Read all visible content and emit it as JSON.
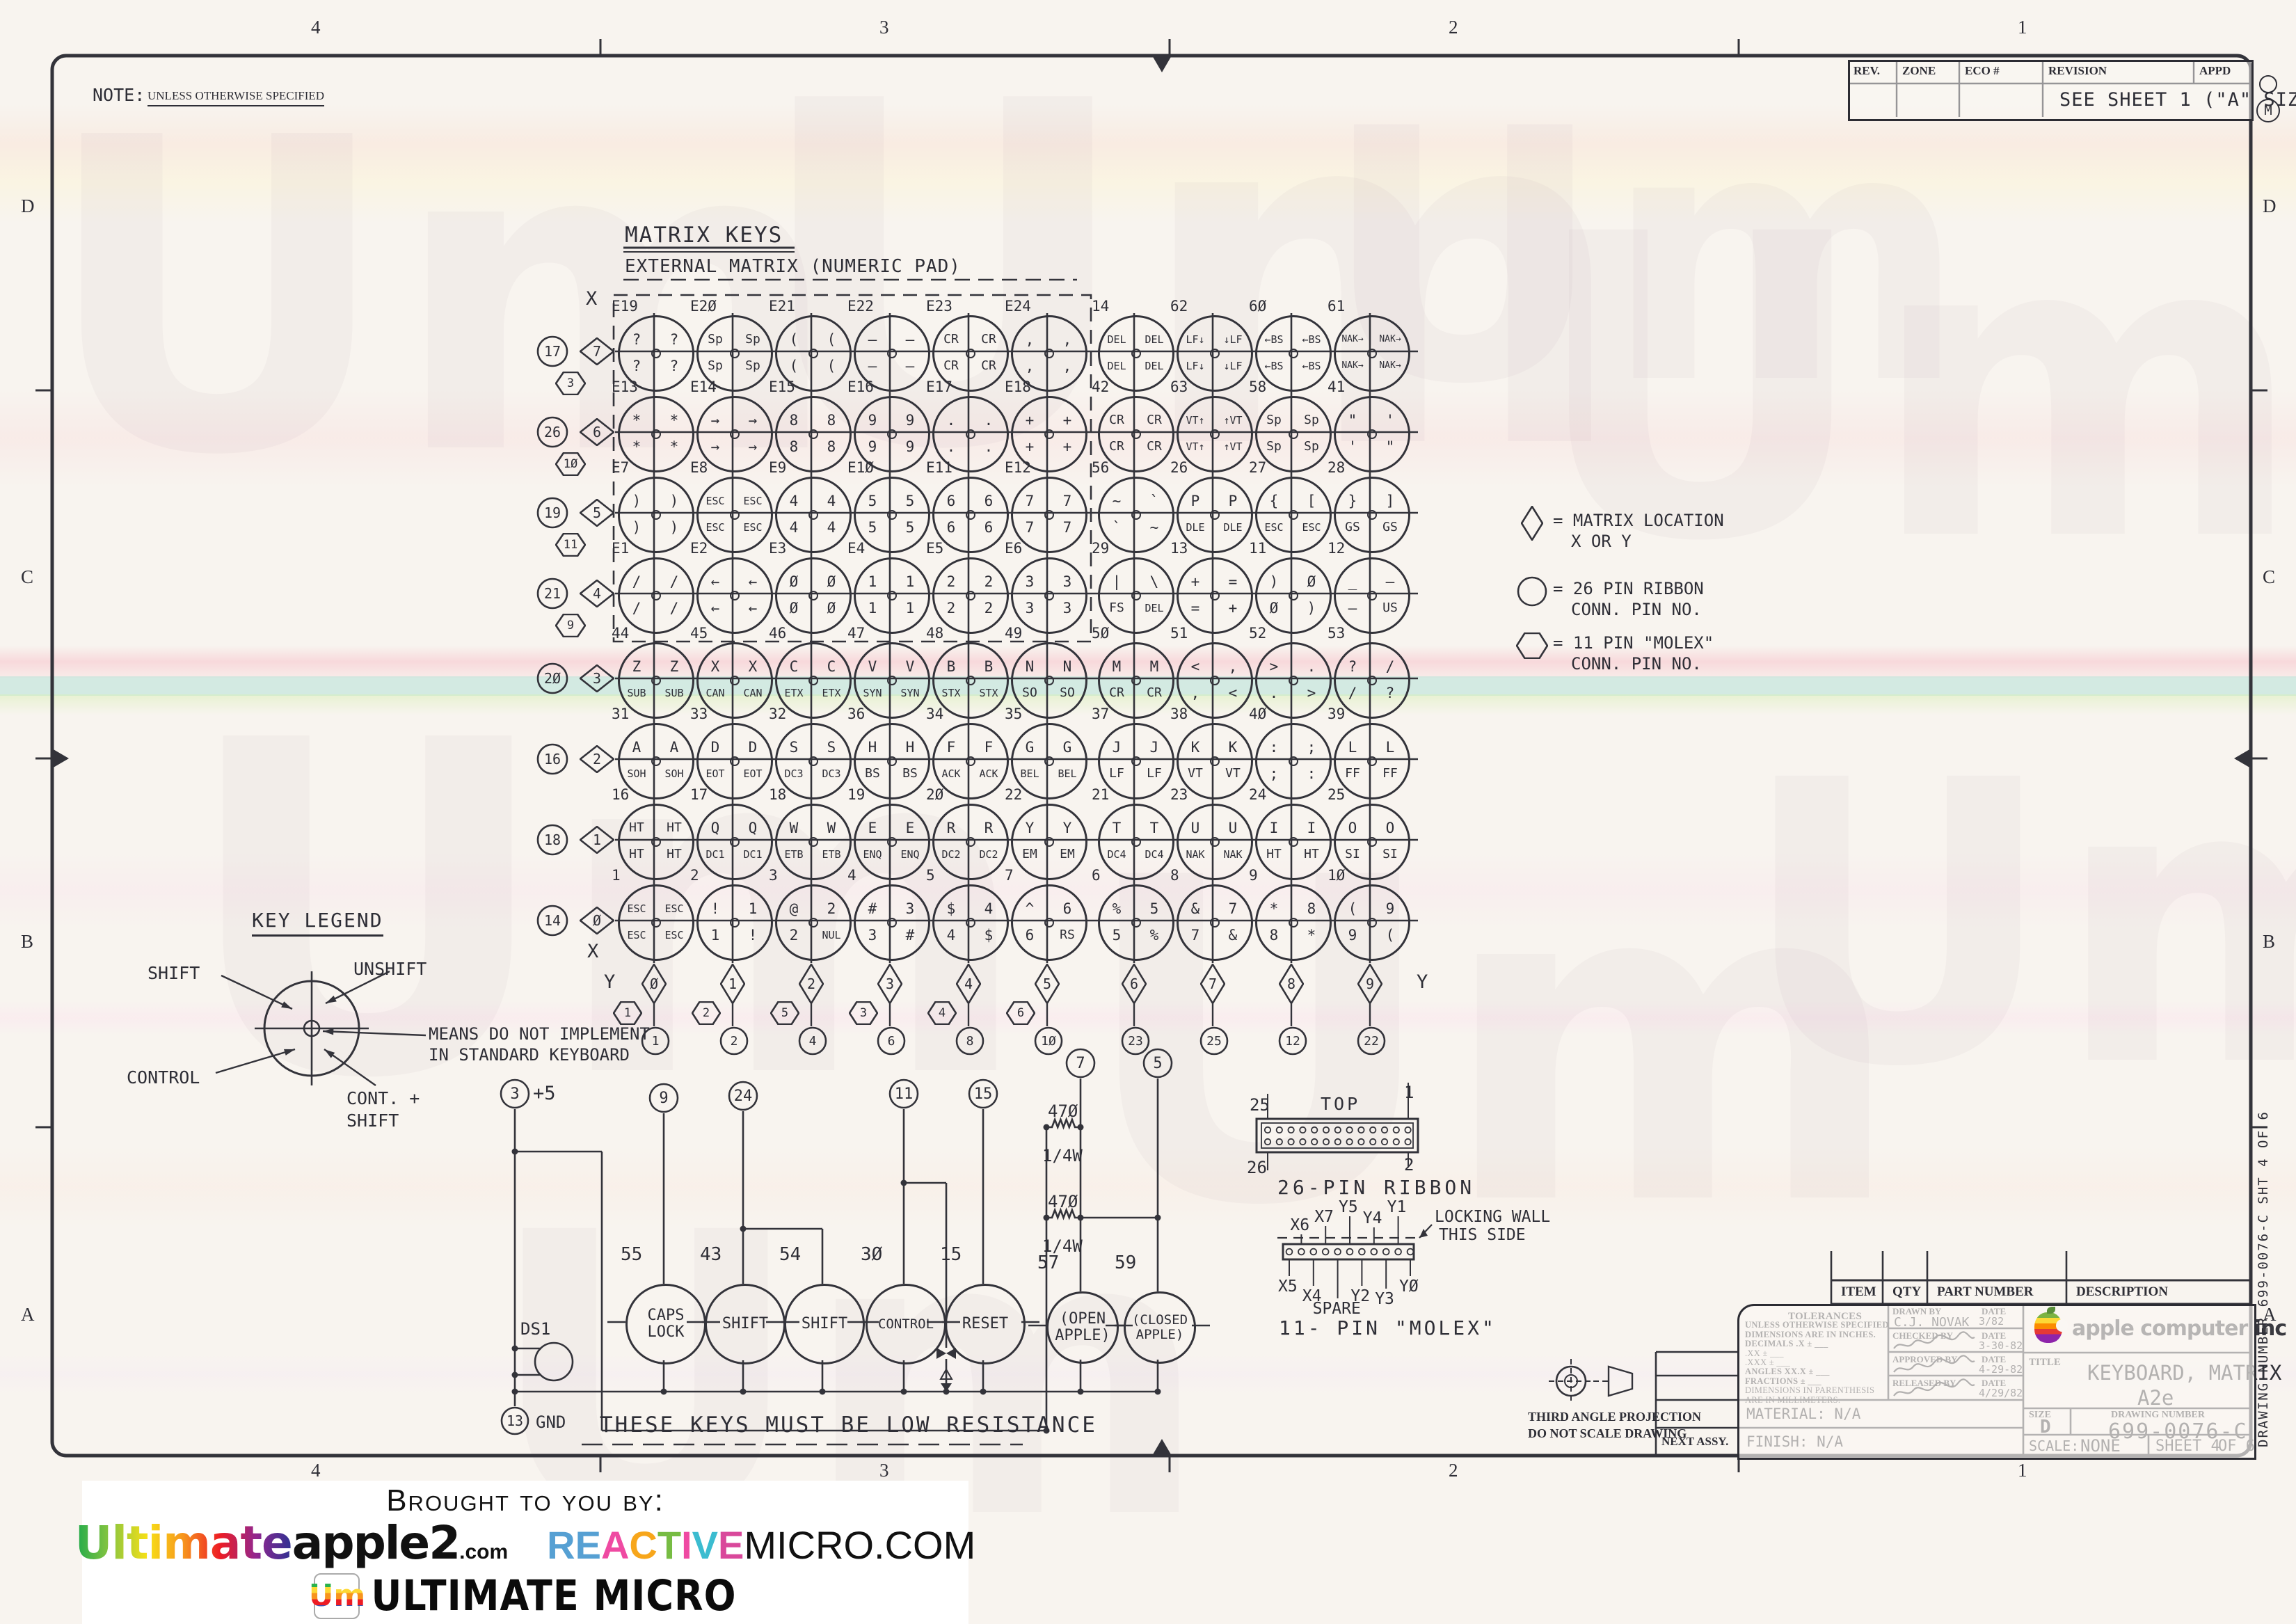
{
  "sheet": {
    "note_label": "NOTE:",
    "note_text": "UNLESS OTHERWISE SPECIFIED",
    "zones_top": [
      "4",
      "3",
      "2",
      "1"
    ],
    "zones_bottom": [
      "4",
      "3",
      "2",
      "1"
    ],
    "zones_left": [
      "D",
      "C",
      "B",
      "A"
    ],
    "zones_right": [
      "D",
      "C",
      "B",
      "A"
    ],
    "corner_stamp": "M",
    "watermark_glyph": "Um"
  },
  "revision_table": {
    "headers": [
      "REV.",
      "ZONE",
      "ECO #",
      "REVISION",
      "APPD"
    ],
    "row_text": "SEE SHEET 1 (\"A\" SIZE)"
  },
  "matrix": {
    "title": "MATRIX KEYS",
    "subtitle": "EXTERNAL MATRIX (NUMERIC PAD)",
    "x_label_top": "X",
    "x_label_bottom": "X",
    "y_label_left": "Y",
    "y_label_right": "Y",
    "x_headers": [
      {
        "circle": "17",
        "diamond": "7",
        "hex": "3"
      },
      {
        "circle": "26",
        "diamond": "6",
        "hex": "1Ø"
      },
      {
        "circle": "19",
        "diamond": "5",
        "hex": "11"
      },
      {
        "circle": "21",
        "diamond": "4",
        "hex": "9"
      },
      {
        "circle": "2Ø",
        "diamond": "3",
        "hex": null
      },
      {
        "circle": "16",
        "diamond": "2",
        "hex": null
      },
      {
        "circle": "18",
        "diamond": "1",
        "hex": null
      },
      {
        "circle": "14",
        "diamond": "Ø",
        "hex": null
      }
    ],
    "y_columns": [
      {
        "diamond": "Ø",
        "hex": "1",
        "circle": "1"
      },
      {
        "diamond": "1",
        "hex": "2",
        "circle": "2"
      },
      {
        "diamond": "2",
        "hex": "5",
        "circle": "4"
      },
      {
        "diamond": "3",
        "hex": "3",
        "circle": "6"
      },
      {
        "diamond": "4",
        "hex": "4",
        "circle": "8"
      },
      {
        "diamond": "5",
        "hex": "6",
        "circle": "1Ø"
      },
      {
        "diamond": "6",
        "hex": null,
        "circle": "23"
      },
      {
        "diamond": "7",
        "hex": null,
        "circle": "25"
      },
      {
        "diamond": "8",
        "hex": null,
        "circle": "12"
      },
      {
        "diamond": "9",
        "hex": null,
        "circle": "22"
      }
    ],
    "rows": [
      {
        "keys": [
          {
            "pin": "E19",
            "tl": "?",
            "tr": "?",
            "bl": "?",
            "br": "?"
          },
          {
            "pin": "E2Ø",
            "tl": "Sp",
            "tr": "Sp",
            "bl": "Sp",
            "br": "Sp"
          },
          {
            "pin": "E21",
            "tl": "(",
            "tr": "(",
            "bl": "(",
            "br": "("
          },
          {
            "pin": "E22",
            "tl": "–",
            "tr": "–",
            "bl": "–",
            "br": "–"
          },
          {
            "pin": "E23",
            "tl": "CR",
            "tr": "CR",
            "bl": "CR",
            "br": "CR"
          },
          {
            "pin": "E24",
            "tl": ",",
            "tr": ",",
            "bl": ",",
            "br": ","
          },
          {
            "pin": "14",
            "tl": "DEL",
            "tr": "DEL",
            "bl": "DEL",
            "br": "DEL"
          },
          {
            "pin": "62",
            "tl": "LF↓",
            "tr": "↓LF",
            "bl": "LF↓",
            "br": "↓LF"
          },
          {
            "pin": "6Ø",
            "tl": "←BS",
            "tr": "←BS",
            "bl": "←BS",
            "br": "←BS"
          },
          {
            "pin": "61",
            "tl": "NAK→",
            "tr": "NAK→",
            "bl": "NAK→",
            "br": "NAK→"
          }
        ]
      },
      {
        "keys": [
          {
            "pin": "E13",
            "tl": "*",
            "tr": "*",
            "bl": "*",
            "br": "*"
          },
          {
            "pin": "E14",
            "tl": "→",
            "tr": "→",
            "bl": "→",
            "br": "→"
          },
          {
            "pin": "E15",
            "tl": "8",
            "tr": "8",
            "bl": "8",
            "br": "8"
          },
          {
            "pin": "E16",
            "tl": "9",
            "tr": "9",
            "bl": "9",
            "br": "9"
          },
          {
            "pin": "E17",
            "tl": ".",
            "tr": ".",
            "bl": ".",
            "br": "."
          },
          {
            "pin": "E18",
            "tl": "+",
            "tr": "+",
            "bl": "+",
            "br": "+"
          },
          {
            "pin": "42",
            "tl": "CR",
            "tr": "CR",
            "bl": "CR",
            "br": "CR"
          },
          {
            "pin": "63",
            "tl": "VT↑",
            "tr": "↑VT",
            "bl": "VT↑",
            "br": "↑VT"
          },
          {
            "pin": "58",
            "tl": "Sp",
            "tr": "Sp",
            "bl": "Sp",
            "br": "Sp"
          },
          {
            "pin": "41",
            "tl": "\"",
            "tr": "'",
            "bl": "'",
            "br": "\""
          }
        ]
      },
      {
        "keys": [
          {
            "pin": "E7",
            "tl": ")",
            "tr": ")",
            "bl": ")",
            "br": ")"
          },
          {
            "pin": "E8",
            "tl": "ESC",
            "tr": "ESC",
            "bl": "ESC",
            "br": "ESC"
          },
          {
            "pin": "E9",
            "tl": "4",
            "tr": "4",
            "bl": "4",
            "br": "4"
          },
          {
            "pin": "E1Ø",
            "tl": "5",
            "tr": "5",
            "bl": "5",
            "br": "5"
          },
          {
            "pin": "E11",
            "tl": "6",
            "tr": "6",
            "bl": "6",
            "br": "6"
          },
          {
            "pin": "E12",
            "tl": "7",
            "tr": "7",
            "bl": "7",
            "br": "7"
          },
          {
            "pin": "56",
            "tl": "~",
            "tr": "`",
            "bl": "`",
            "br": "~"
          },
          {
            "pin": "26",
            "tl": "P",
            "tr": "P",
            "bl": "DLE",
            "br": "DLE"
          },
          {
            "pin": "27",
            "tl": "{",
            "tr": "[",
            "bl": "ESC",
            "br": "ESC"
          },
          {
            "pin": "28",
            "tl": "}",
            "tr": "]",
            "bl": "GS",
            "br": "GS"
          }
        ]
      },
      {
        "keys": [
          {
            "pin": "E1",
            "tl": "/",
            "tr": "/",
            "bl": "/",
            "br": "/"
          },
          {
            "pin": "E2",
            "tl": "←",
            "tr": "←",
            "bl": "←",
            "br": "←"
          },
          {
            "pin": "E3",
            "tl": "Ø",
            "tr": "Ø",
            "bl": "Ø",
            "br": "Ø"
          },
          {
            "pin": "E4",
            "tl": "1",
            "tr": "1",
            "bl": "1",
            "br": "1"
          },
          {
            "pin": "E5",
            "tl": "2",
            "tr": "2",
            "bl": "2",
            "br": "2"
          },
          {
            "pin": "E6",
            "tl": "3",
            "tr": "3",
            "bl": "3",
            "br": "3"
          },
          {
            "pin": "29",
            "tl": "|",
            "tr": "\\",
            "bl": "FS",
            "br": "DEL"
          },
          {
            "pin": "13",
            "tl": "+",
            "tr": "=",
            "bl": "=",
            "br": "+"
          },
          {
            "pin": "11",
            "tl": ")",
            "tr": "Ø",
            "bl": "Ø",
            "br": ")"
          },
          {
            "pin": "12",
            "tl": "_",
            "tr": "–",
            "bl": "–",
            "br": "US"
          }
        ]
      },
      {
        "keys": [
          {
            "pin": "44",
            "tl": "Z",
            "tr": "Z",
            "bl": "SUB",
            "br": "SUB"
          },
          {
            "pin": "45",
            "tl": "X",
            "tr": "X",
            "bl": "CAN",
            "br": "CAN"
          },
          {
            "pin": "46",
            "tl": "C",
            "tr": "C",
            "bl": "ETX",
            "br": "ETX"
          },
          {
            "pin": "47",
            "tl": "V",
            "tr": "V",
            "bl": "SYN",
            "br": "SYN"
          },
          {
            "pin": "48",
            "tl": "B",
            "tr": "B",
            "bl": "STX",
            "br": "STX"
          },
          {
            "pin": "49",
            "tl": "N",
            "tr": "N",
            "bl": "SO",
            "br": "SO"
          },
          {
            "pin": "5Ø",
            "tl": "M",
            "tr": "M",
            "bl": "CR",
            "br": "CR"
          },
          {
            "pin": "51",
            "tl": "<",
            "tr": ",",
            "bl": ",",
            "br": "<"
          },
          {
            "pin": "52",
            "tl": ">",
            "tr": ".",
            "bl": ".",
            "br": ">"
          },
          {
            "pin": "53",
            "tl": "?",
            "tr": "/",
            "bl": "/",
            "br": "?"
          }
        ]
      },
      {
        "keys": [
          {
            "pin": "31",
            "tl": "A",
            "tr": "A",
            "bl": "SOH",
            "br": "SOH"
          },
          {
            "pin": "33",
            "tl": "D",
            "tr": "D",
            "bl": "EOT",
            "br": "EOT"
          },
          {
            "pin": "32",
            "tl": "S",
            "tr": "S",
            "bl": "DC3",
            "br": "DC3"
          },
          {
            "pin": "36",
            "tl": "H",
            "tr": "H",
            "bl": "BS",
            "br": "BS"
          },
          {
            "pin": "34",
            "tl": "F",
            "tr": "F",
            "bl": "ACK",
            "br": "ACK"
          },
          {
            "pin": "35",
            "tl": "G",
            "tr": "G",
            "bl": "BEL",
            "br": "BEL"
          },
          {
            "pin": "37",
            "tl": "J",
            "tr": "J",
            "bl": "LF",
            "br": "LF"
          },
          {
            "pin": "38",
            "tl": "K",
            "tr": "K",
            "bl": "VT",
            "br": "VT"
          },
          {
            "pin": "4Ø",
            "tl": ":",
            "tr": ";",
            "bl": ";",
            "br": ":"
          },
          {
            "pin": "39",
            "tl": "L",
            "tr": "L",
            "bl": "FF",
            "br": "FF"
          }
        ]
      },
      {
        "keys": [
          {
            "pin": "16",
            "tl": "HT",
            "tr": "HT",
            "bl": "HT",
            "br": "HT"
          },
          {
            "pin": "17",
            "tl": "Q",
            "tr": "Q",
            "bl": "DC1",
            "br": "DC1"
          },
          {
            "pin": "18",
            "tl": "W",
            "tr": "W",
            "bl": "ETB",
            "br": "ETB"
          },
          {
            "pin": "19",
            "tl": "E",
            "tr": "E",
            "bl": "ENQ",
            "br": "ENQ"
          },
          {
            "pin": "2Ø",
            "tl": "R",
            "tr": "R",
            "bl": "DC2",
            "br": "DC2"
          },
          {
            "pin": "22",
            "tl": "Y",
            "tr": "Y",
            "bl": "EM",
            "br": "EM"
          },
          {
            "pin": "21",
            "tl": "T",
            "tr": "T",
            "bl": "DC4",
            "br": "DC4"
          },
          {
            "pin": "23",
            "tl": "U",
            "tr": "U",
            "bl": "NAK",
            "br": "NAK"
          },
          {
            "pin": "24",
            "tl": "I",
            "tr": "I",
            "bl": "HT",
            "br": "HT"
          },
          {
            "pin": "25",
            "tl": "O",
            "tr": "O",
            "bl": "SI",
            "br": "SI"
          }
        ]
      },
      {
        "keys": [
          {
            "pin": "1",
            "tl": "ESC",
            "tr": "ESC",
            "bl": "ESC",
            "br": "ESC"
          },
          {
            "pin": "2",
            "tl": "!",
            "tr": "1",
            "bl": "1",
            "br": "!"
          },
          {
            "pin": "3",
            "tl": "@",
            "tr": "2",
            "bl": "2",
            "br": "NUL"
          },
          {
            "pin": "4",
            "tl": "#",
            "tr": "3",
            "bl": "3",
            "br": "#"
          },
          {
            "pin": "5",
            "tl": "$",
            "tr": "4",
            "bl": "4",
            "br": "$"
          },
          {
            "pin": "7",
            "tl": "^",
            "tr": "6",
            "bl": "6",
            "br": "RS"
          },
          {
            "pin": "6",
            "tl": "%",
            "tr": "5",
            "bl": "5",
            "br": "%"
          },
          {
            "pin": "8",
            "tl": "&",
            "tr": "7",
            "bl": "7",
            "br": "&"
          },
          {
            "pin": "9",
            "tl": "*",
            "tr": "8",
            "bl": "8",
            "br": "*"
          },
          {
            "pin": "1Ø",
            "tl": "(",
            "tr": "9",
            "bl": "9",
            "br": "("
          }
        ]
      }
    ]
  },
  "legend": {
    "items": [
      {
        "symbol": "diamond",
        "text1": "= MATRIX LOCATION",
        "text2": "X OR Y"
      },
      {
        "symbol": "circle",
        "text1": "= 26 PIN RIBBON",
        "text2": "CONN. PIN NO."
      },
      {
        "symbol": "hexagon",
        "text1": "= 11 PIN \"MOLEX\"",
        "text2": "CONN. PIN NO."
      }
    ]
  },
  "key_legend": {
    "title": "KEY LEGEND",
    "shift": "SHIFT",
    "unshift": "UNSHIFT",
    "control": "CONTROL",
    "cont_shift_1": "CONT. +",
    "cont_shift_2": "SHIFT",
    "note_1": "MEANS DO NOT IMPLEMENT",
    "note_2": "IN STANDARD KEYBOARD"
  },
  "switch_section": {
    "plus5_pin": "3",
    "plus5_label": "+5",
    "gnd_pin": "13",
    "gnd_label": "GND",
    "lamp_label": "DS1",
    "terminals": [
      "9",
      "24",
      "11",
      "15",
      "7",
      "5"
    ],
    "resistors": [
      {
        "value": "47Ø",
        "watt": "1/4W"
      },
      {
        "value": "47Ø",
        "watt": "1/4W"
      }
    ],
    "switches": [
      {
        "pin": "55",
        "line1": "CAPS",
        "line2": "LOCK"
      },
      {
        "pin": "43",
        "line1": "SHIFT",
        "line2": ""
      },
      {
        "pin": "54",
        "line1": "SHIFT",
        "line2": ""
      },
      {
        "pin": "3Ø",
        "line1": "CONTROL",
        "line2": ""
      },
      {
        "pin": "15",
        "line1": "RESET",
        "line2": ""
      },
      {
        "pin": "57",
        "line1": "(OPEN",
        "line2": "APPLE)"
      },
      {
        "pin": "59",
        "line1": "(CLOSED",
        "line2": "APPLE)"
      }
    ],
    "note": "THESE KEYS MUST BE LOW RESISTANCE"
  },
  "connectors": {
    "ribbon": {
      "top_label": "TOP",
      "pin_tl": "25",
      "pin_tr": "1",
      "pin_bl": "26",
      "pin_br": "2",
      "caption": "26-PIN RIBBON"
    },
    "molex": {
      "labels_above": [
        "X6",
        "X7",
        "Y5",
        "Y4",
        "Y1"
      ],
      "labels_below": [
        "X5",
        "X4",
        "SPARE",
        "Y2",
        "Y3",
        "YØ"
      ],
      "annotation1": "LOCKING WALL",
      "annotation2": "THIS SIDE",
      "caption": "11- PIN \"MOLEX\""
    }
  },
  "title_block": {
    "parts_headers": [
      "ITEM",
      "QTY",
      "PART NUMBER",
      "DESCRIPTION"
    ],
    "tolerances_lines": [
      "TOLERANCES",
      "UNLESS OTHERWISE SPECIFIED",
      "DIMENSIONS ARE IN INCHES.",
      "DECIMALS      .X ± ___",
      "             .XX ± ___",
      "            .XXX ± ___",
      "ANGLES     XX.X ± ___",
      "FRACTIONS        ± ___",
      "DIMENSIONS IN PARENTHESIS",
      "ARE IN MILLIMETERS."
    ],
    "signatures": [
      {
        "label": "DRAWN BY",
        "date_label": "DATE",
        "name": "C.J. NOVAK",
        "date": "3/82"
      },
      {
        "label": "CHECKED BY",
        "date_label": "DATE",
        "name": "",
        "date": "3-30-82"
      },
      {
        "label": "APPROVED BY",
        "date_label": "DATE",
        "name": "",
        "date": "4-29-82"
      },
      {
        "label": "RELEASED BY",
        "date_label": "DATE",
        "name": "",
        "date": "4/29/82"
      }
    ],
    "company": "apple computer inc",
    "title_label": "TITLE",
    "title_line1": "KEYBOARD, MATRIX",
    "title_line2": "A2e",
    "size_label": "SIZE",
    "size": "D",
    "drawing_number_label": "DRAWING NUMBER",
    "drawing_number": "699-0076-C",
    "material_label": "MATERIAL:",
    "material": "N/A",
    "next_assy": "NEXT ASSY.",
    "finish_label": "FINISH:",
    "finish": "N/A",
    "scale_label": "SCALE:",
    "scale": "NONE",
    "sheet_text": "SHEET 4",
    "of_text": "OF 6",
    "projection_line1": "THIRD ANGLE PROJECTION",
    "projection_line2": "DO NOT SCALE DRAWING",
    "edge_text": "DRAWING NUMBER  699-0076-C   SHT 4 OF 6"
  },
  "banner": {
    "heading": "Brought to you by:",
    "logo1_rainbow": "Ultimate",
    "logo1_black": "apple2",
    "logo1_suffix": ".com",
    "logo2_letters": [
      {
        "ch": "R",
        "c": "#56a0d3"
      },
      {
        "ch": "E",
        "c": "#56a0d3"
      },
      {
        "ch": "A",
        "c": "#ef4aa2"
      },
      {
        "ch": "C",
        "c": "#f7a61b"
      },
      {
        "ch": "T",
        "c": "#77bc43"
      },
      {
        "ch": "I",
        "c": "#ef4aa2"
      },
      {
        "ch": "V",
        "c": "#3bbcd0"
      },
      {
        "ch": "E",
        "c": "#d9489b"
      }
    ],
    "logo2_black": "MICRO.COM",
    "logo3_mark": "Um",
    "logo3_text": "ULTIMATE MICRO"
  },
  "colors": {
    "ink": "#2e2e36",
    "paper": "#f8f4ef",
    "band_pink": "#f5c3cc",
    "band_cyan": "#bfe4da",
    "band_green": "#d8ecb4"
  }
}
